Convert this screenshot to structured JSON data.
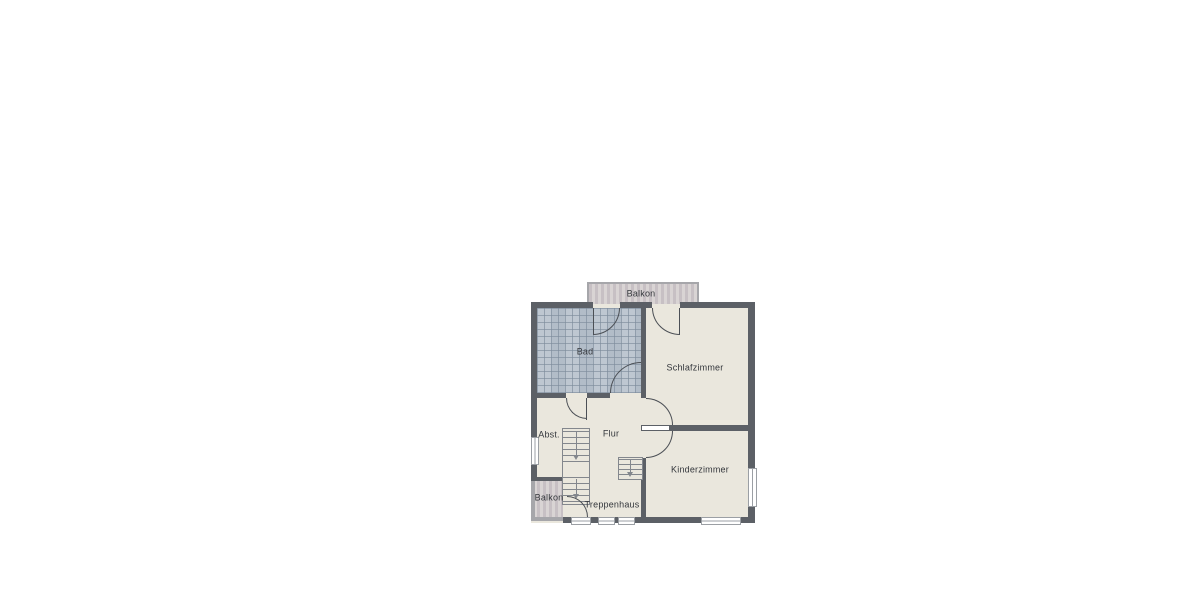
{
  "floorplan": {
    "rooms": [
      {
        "id": "balkon-top",
        "label": "Balkon"
      },
      {
        "id": "bad",
        "label": "Bad"
      },
      {
        "id": "schlafzimmer",
        "label": "Schlafzimmer"
      },
      {
        "id": "abstellraum",
        "label": "Abst."
      },
      {
        "id": "flur",
        "label": "Flur"
      },
      {
        "id": "kinderzimmer",
        "label": "Kinderzimmer"
      },
      {
        "id": "balkon-bottom",
        "label": "Balkon"
      },
      {
        "id": "treppenhaus",
        "label": "Treppenhaus"
      }
    ],
    "colors": {
      "wall": "#5c6066",
      "floor": "#eae7dd",
      "tile": "#b9c3ce",
      "balcony_stripe_light": "#d9d4d4",
      "balcony_stripe_dark": "#c7c0c4",
      "balcony_wall": "#a6a6aa",
      "stair_line": "#83878d",
      "door": "#4b4f55",
      "label_text": "#34373c",
      "background": "#ffffff"
    }
  }
}
